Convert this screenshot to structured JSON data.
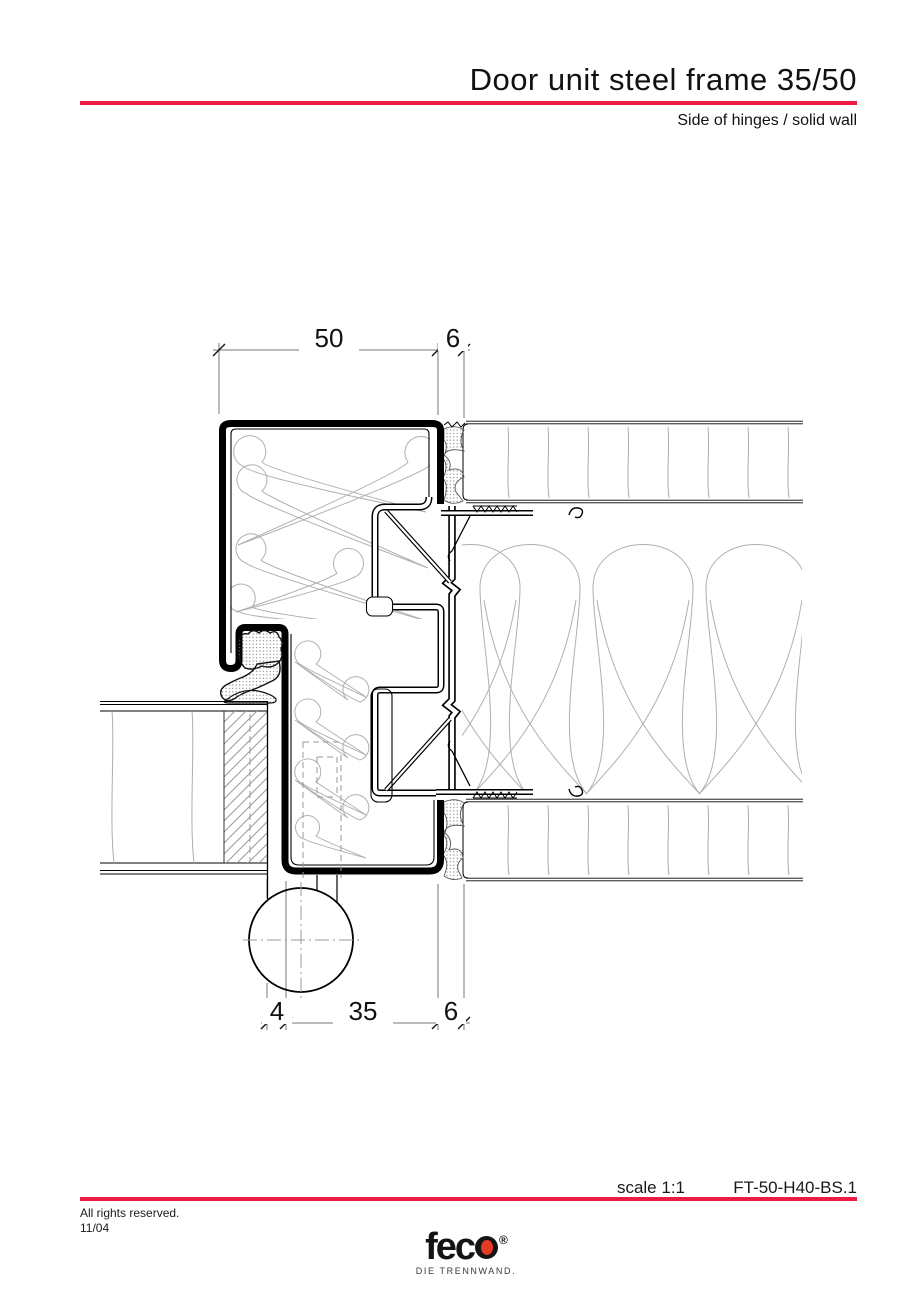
{
  "header": {
    "title": "Door unit steel frame 35/50",
    "subtitle": "Side of hinges / solid wall"
  },
  "drawing": {
    "type": "technical-section-detail",
    "dims": {
      "top_frame_width": "50",
      "top_joint": "6",
      "bottom_hinge_gap": "4",
      "bottom_frame_depth": "35",
      "bottom_joint": "6"
    }
  },
  "footer": {
    "scale": "scale 1:1",
    "drawing_number": "FT-50-H40-BS.1",
    "rights": "All rights reserved.",
    "date": "11/04"
  },
  "logo": {
    "prefix": "fec",
    "registered": "®",
    "tagline": "DIE TRENNWAND."
  },
  "colors": {
    "accent_red": "#ed1a43",
    "logo_dot_red": "#e63b22",
    "line_black": "#000000",
    "insulation_gray": "#b0b0b0",
    "extension_gray": "#777777"
  }
}
